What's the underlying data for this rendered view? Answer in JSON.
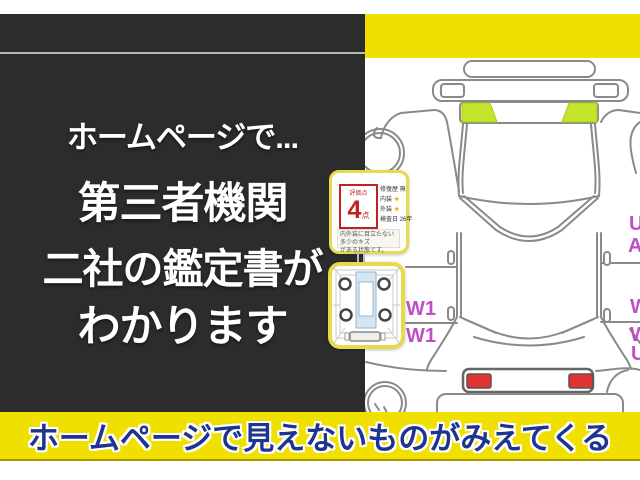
{
  "colors": {
    "panel_bg": "#2c2c2c",
    "accent_yellow": "#f0e000",
    "banner_text_navy": "#1e3590",
    "highlight_green": "#c3e62c",
    "lamp_red": "#e23333",
    "damage_label_magenta": "#bf4fc5",
    "card_border_yellow": "#e6da4e",
    "score_red": "#c22121"
  },
  "left_panel": {
    "lines": [
      "ホームページで...",
      "第三者機関",
      "二社の鑑定書が",
      "わかります"
    ]
  },
  "banner": {
    "text": "ホームページで見えないものがみえてくる"
  },
  "diagram": {
    "labels": {
      "w1_top": "W1",
      "w1_bottom": "W1",
      "right_u": "U",
      "right_a": "A",
      "right_w1": "W",
      "right_w2": "W",
      "right_u2": "U"
    }
  },
  "rating_card": {
    "score_label": "評価点",
    "score": "4",
    "score_unit": "点",
    "rows": [
      {
        "label": "修復歴",
        "value": "無"
      },
      {
        "label": "内装",
        "value": "★"
      },
      {
        "label": "外装",
        "value": "★"
      },
      {
        "label": "検査日",
        "value": "26年"
      }
    ],
    "note_lines": [
      "内外装に目立たない多少のキズ",
      "がある状態です。"
    ]
  }
}
